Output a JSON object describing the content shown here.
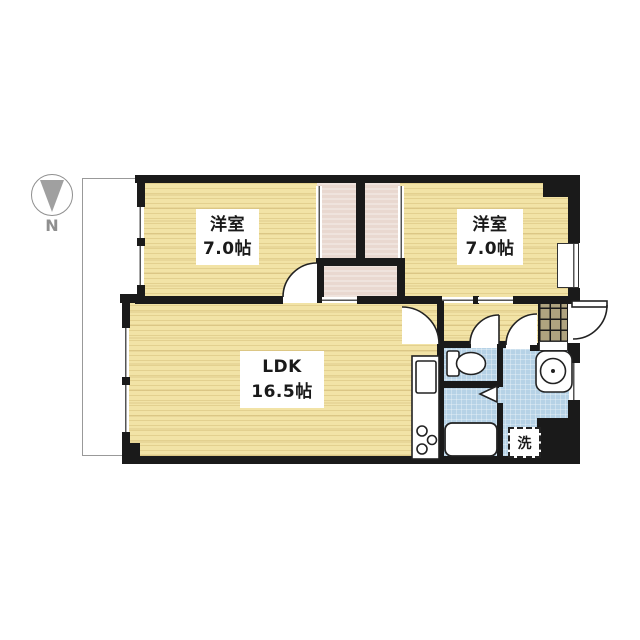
{
  "compass": {
    "label": "N"
  },
  "rooms": {
    "bedroom_west": {
      "name": "洋室",
      "size": "7.0帖"
    },
    "bedroom_east": {
      "name": "洋室",
      "size": "7.0帖"
    },
    "ldk": {
      "name": "LDK",
      "size": "16.5帖"
    },
    "laundry": {
      "label": "洗"
    }
  },
  "colors": {
    "wood_floor": "#f2e3a6",
    "closet_floor": "#e9d8d0",
    "wet_area_floor": "#b6d2e6",
    "entrance_tile": "#afa37f",
    "wall": "#1a1a1a",
    "fixture_outline": "#222222",
    "compass_gray": "#8f8f8f",
    "balcony_border": "#999999"
  }
}
